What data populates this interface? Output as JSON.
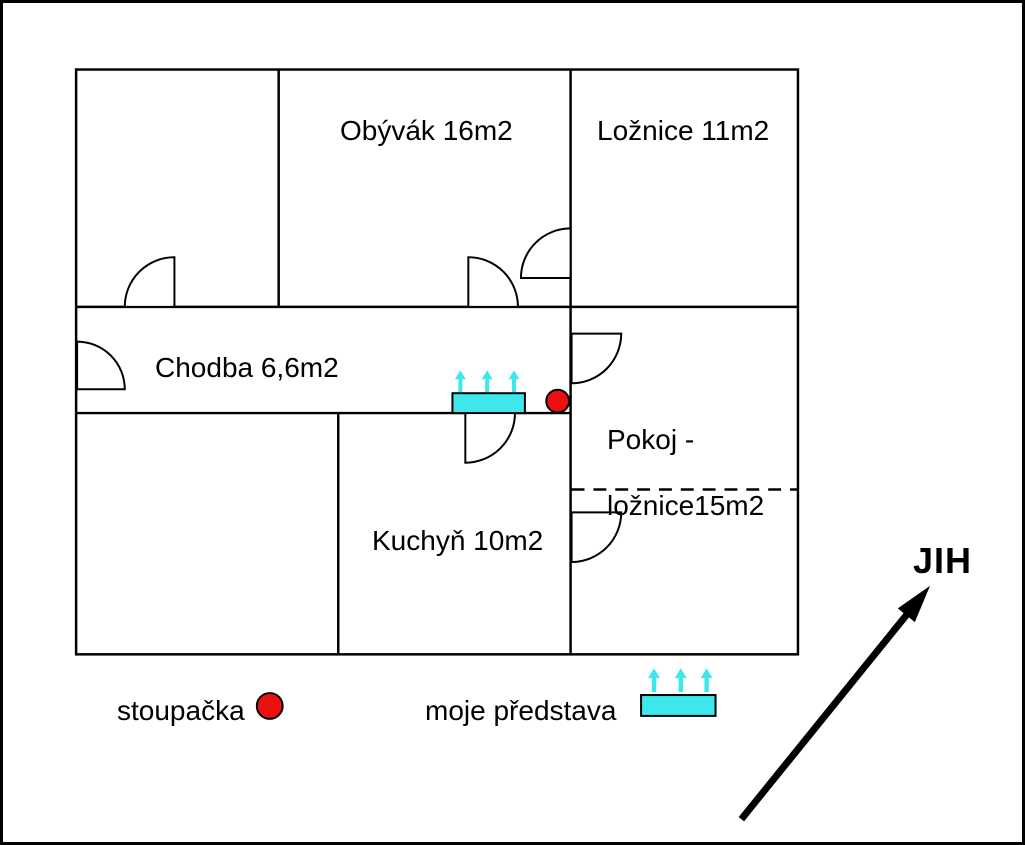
{
  "rooms": {
    "obyvak": {
      "label": "Obývák 16m2"
    },
    "loznice": {
      "label": "Ložnice 11m2"
    },
    "chodba": {
      "label": "Chodba 6,6m2"
    },
    "pokoj": {
      "label_line1": "Pokoj -",
      "label_line2": "ložnice15m2"
    },
    "kuchyn": {
      "label": "Kuchyň 10m2"
    }
  },
  "legend": {
    "riser": {
      "label": "stoupačka"
    },
    "radiator": {
      "label": "moje představa"
    }
  },
  "compass": {
    "label": "JIH"
  },
  "colors": {
    "riser_red": "#ec1111",
    "radiator_cyan": "#3ee7eb",
    "wall_black": "#000000"
  }
}
